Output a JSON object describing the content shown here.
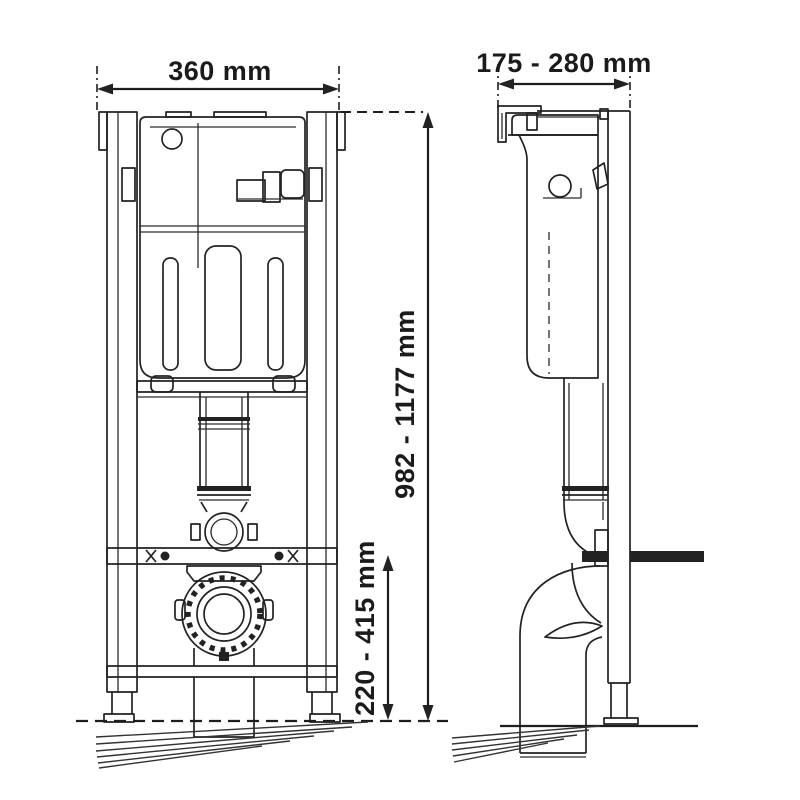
{
  "drawing": {
    "colors": {
      "line": "#222222",
      "background": "#ffffff"
    },
    "dimensions": {
      "frame_width": {
        "value": "360 mm",
        "orientation": "horizontal"
      },
      "install_depth": {
        "value": "175 - 280 mm",
        "orientation": "horizontal"
      },
      "frame_height": {
        "value": "982 - 1177 mm",
        "orientation": "vertical"
      },
      "outlet_height": {
        "value": "220 - 415 mm",
        "orientation": "vertical"
      }
    }
  }
}
